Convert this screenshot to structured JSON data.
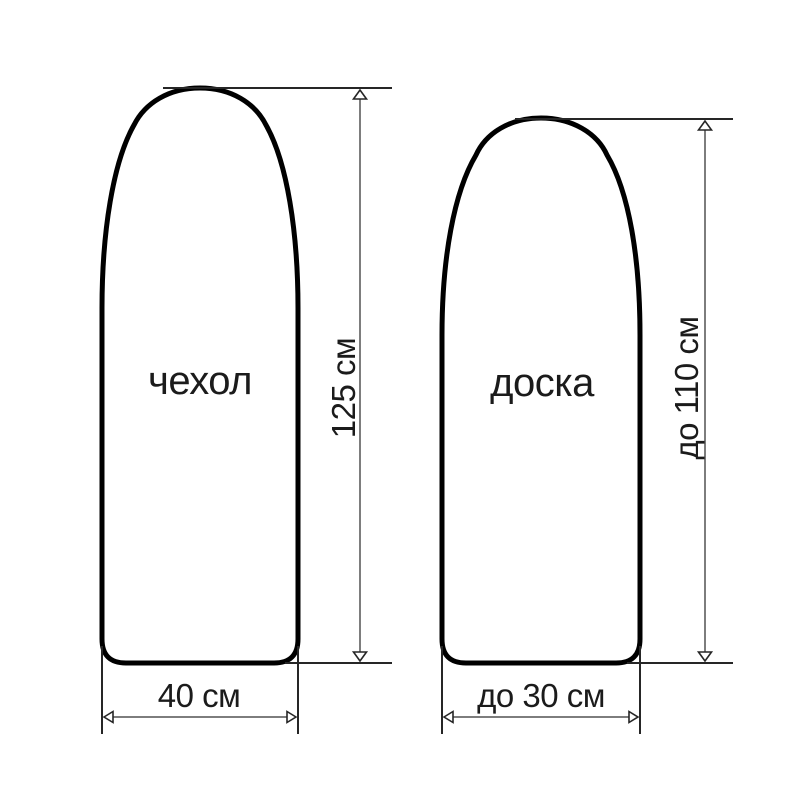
{
  "diagram": {
    "type": "product-dimension-diagram",
    "background": "#ffffff",
    "colors": {
      "outline": "#000000",
      "extension_line": "#262626",
      "dimension_line": "#7d7d7d",
      "text": "#1b1b1b"
    },
    "figures": [
      {
        "id": "cover",
        "label": "чехол",
        "height_label": "125 см",
        "width_label": "40 см"
      },
      {
        "id": "board",
        "label": "доска",
        "height_label": "до 110 см",
        "width_label": "до 30 см"
      }
    ]
  }
}
